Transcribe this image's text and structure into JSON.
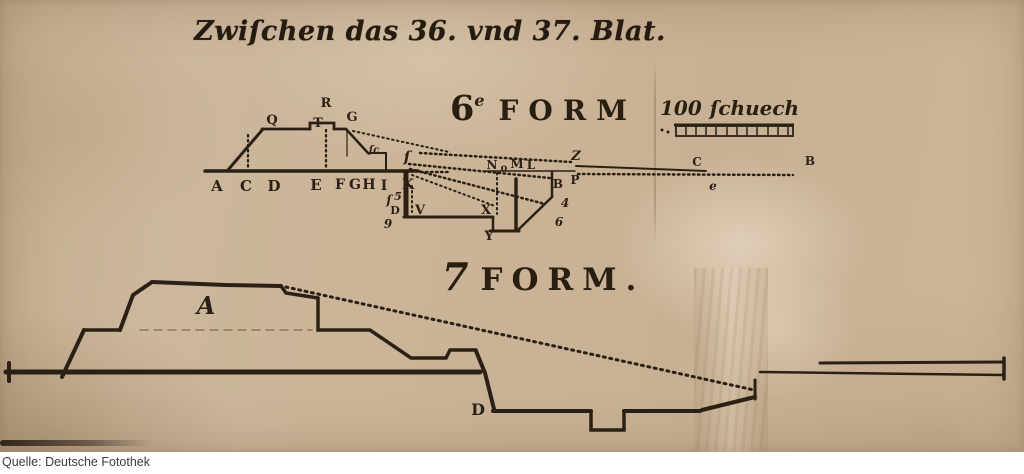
{
  "title": {
    "text": "Zwiſchen das 36. vnd 37. Blat."
  },
  "form6": {
    "number": "6",
    "superscript": "e",
    "word": "FORM",
    "scale": {
      "value": "100",
      "unit": "ſchuech"
    },
    "letters": [
      "Q",
      "R",
      "T",
      "G",
      "A",
      "C",
      "D",
      "E",
      "F",
      "G",
      "H",
      "I",
      "K",
      "ſ",
      "ſc",
      "ſ",
      "5",
      "D",
      "9",
      "V",
      "X",
      "Y",
      "N",
      "o",
      "M",
      "L",
      "Z",
      "B",
      "P",
      "4",
      "6",
      "C",
      "e",
      "B"
    ]
  },
  "form7": {
    "number": "7",
    "word": "FORM.",
    "letters": [
      "A",
      "D"
    ]
  },
  "caption": {
    "text": "Quelle: Deutsche Fotothek"
  },
  "colors": {
    "paper": "#cbb397",
    "ink": "#2a2114",
    "caption_background": "#ffffff",
    "caption_text": "#3c3c3c"
  }
}
